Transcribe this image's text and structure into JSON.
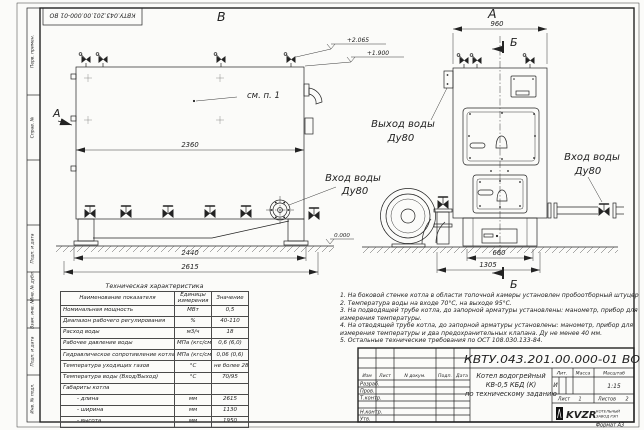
{
  "stamp_rotated": "КВТУ.043.201.00.000-01 ВО",
  "frame": {
    "left_labels": [
      "Перв. примен.",
      "Справ. №",
      "Подп. и дата",
      "Инв. № дубл.",
      "Взам. инв. №",
      "Подп. и дата",
      "Инв. № подл."
    ]
  },
  "labels": {
    "view_b": "В",
    "view_a": "А",
    "cut_a": "А",
    "cut_b_top": "Б",
    "cut_b_bottom": "Б",
    "see_note": "см. п. 1",
    "dim_2360": "2360",
    "dim_2440": "2440",
    "dim_2615": "2615",
    "dim_960": "960",
    "dim_660": "660",
    "dim_1305": "1305",
    "elev_1": "+2.065",
    "elev_2": "+1.900",
    "elev_0": "0.000",
    "inlet_side_1": "Вход воды",
    "inlet_side_2": "Ду80",
    "outlet_front_1": "Выход воды",
    "outlet_front_2": "Ду80",
    "inlet_front_1": "Вход воды",
    "inlet_front_2": "Ду80"
  },
  "spec_table": {
    "title": "Техническая характеристика",
    "col_name": "Наименование показателя",
    "col_units": "Единицы измерения",
    "col_value": "Значение",
    "rows": [
      [
        "Номинальная мощность",
        "МВт",
        "0,5"
      ],
      [
        "Диапазон рабочего регулирования",
        "%",
        "40-110"
      ],
      [
        "Расход воды",
        "м3/ч",
        "18"
      ],
      [
        "Рабочее давление воды",
        "МПа (кгс/см2)",
        "0,6 (6,0)"
      ],
      [
        "Гидравлическое сопротивление котла",
        "МПа (кгс/см2)",
        "0,06 (0,6)"
      ],
      [
        "Температура уходящих газов",
        "°С",
        "не более 280"
      ],
      [
        "Температура воды (Вход/Выход)",
        "°С",
        "70/95"
      ],
      [
        "Габариты котла",
        "",
        ""
      ],
      [
        "- длина",
        "мм",
        "2615"
      ],
      [
        "- ширина",
        "мм",
        "1130"
      ],
      [
        "- высота",
        "мм",
        "1950"
      ]
    ]
  },
  "notes": [
    "1. На боковой стенке котла в области топочной камеры установлен пробоотборный штуцер",
    "2. Температура воды на входе 70°С, на выходе 95°С.",
    "3. На подводящей трубе котла, до запорной арматуры установлены: манометр, прибор для",
    "измерения температуры.",
    "4. На отводящей трубе котла, до запорной арматуры установлены: манометр, прибор для",
    "измерения температуры и два предохранительных клапана. Ду не менее 40 мм.",
    "5. Остальные технические требования по ОСТ 108.030.133-84."
  ],
  "title_block": {
    "doc_number": "КВТУ.043.201.00.000-01 ВО",
    "sig_headers": [
      "Изм",
      "Лист",
      "N докум.",
      "Подп.",
      "Дата"
    ],
    "sig_rows": [
      "Разраб.",
      "Пров.",
      "Т.контр.",
      "Н.контр.",
      "Утв."
    ],
    "name_line1": "Котел водогрейный",
    "name_line2": "КВ-0,5 КБД (К)",
    "name_line3": "по техническому заданию",
    "lit_header": "Лит.",
    "mass_header": "Масса",
    "scale_header": "Масштаб",
    "lit_value": "И",
    "scale_value": "1:15",
    "sheet_label": "Лист",
    "sheet_value": "1",
    "sheets_label": "Листов",
    "sheets_value": "2",
    "company_logo": "KVZR",
    "company_line1": "КОТЕЛЬНЫЙ",
    "company_line2": "ЗАВОД РЭП",
    "format_label": "Формат  А3"
  }
}
